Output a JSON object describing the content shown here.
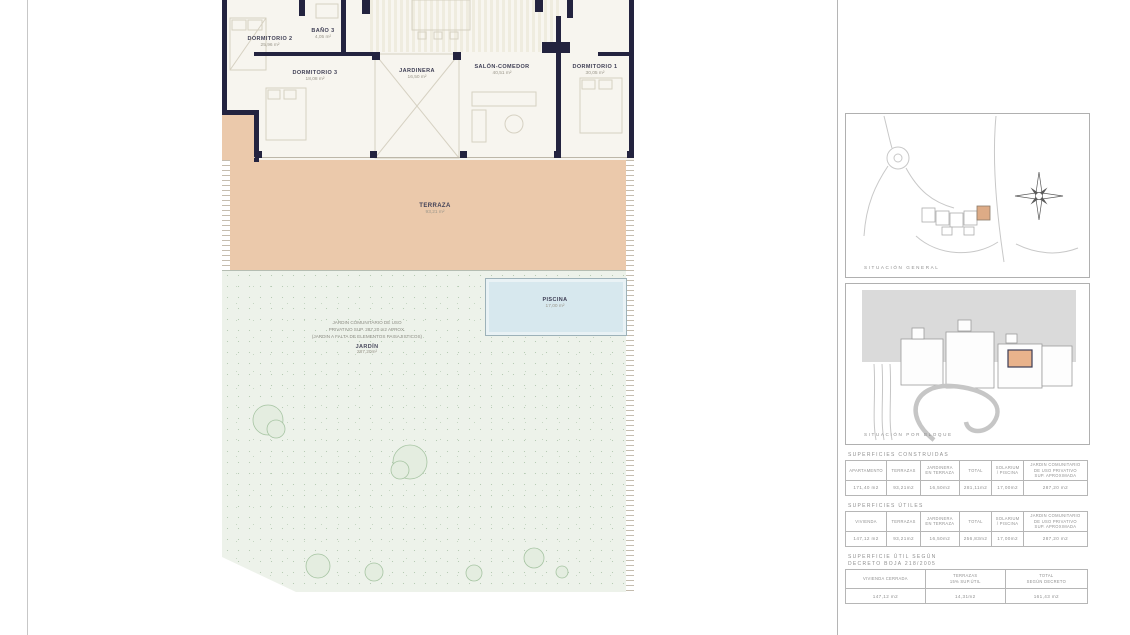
{
  "sheet": {
    "plan": {
      "rooms": [
        {
          "name": "DORMITORIO 2",
          "area": "25,96 m²"
        },
        {
          "name": "BAÑO 3",
          "area": "4,05 m²"
        },
        {
          "name": "DORMITORIO 3",
          "area": "18,08 m²"
        },
        {
          "name": "JARDINERA",
          "area": "16,50 m²"
        },
        {
          "name": "SALÓN-COMEDOR",
          "area": "40,51 m²"
        },
        {
          "name": "DORMITORIO 1",
          "area": "30,05 m²"
        }
      ],
      "terraza": {
        "name": "TERRAZA",
        "area": "93,21 m²"
      },
      "piscina": {
        "name": "PISCINA",
        "area": "17,00 m²"
      },
      "jardin": {
        "note": "JARDIN COMUNITARIO DE USO\nPRIVATIVO SUP. 287,20 m2 APROX.\n(JARDIN A FALTA DE ELEMENTOS PAISAJISTICOS)",
        "name": "JARDÍN",
        "area": "287,20m²"
      }
    },
    "sidebar": {
      "map_general_label": "SITUACIÓN GENERAL",
      "map_bloque_label": "SITUACIÓN POR BLOQUE",
      "tables": [
        {
          "title": "SUPERFICIES CONSTRUIDAS",
          "headers": [
            "APARTAMENTO",
            "TERRAZAS",
            "JARDINERA\nEN TERRAZA",
            "TOTAL",
            "SOLARIUM\n/ PISCINA",
            "JARDIN COMUNITARIO\nDE USO PRIVATIVO\nSUP. APROXIMADA"
          ],
          "values": [
            "171,40 m2",
            "93,21m2",
            "16,50m2",
            "281,11m2",
            "17,00m2",
            "287,20 m2"
          ]
        },
        {
          "title": "SUPERFICIES ÚTILES",
          "headers": [
            "VIVIENDA",
            "TERRAZAS",
            "JARDINERA\nEN TERRAZA",
            "TOTAL",
            "SOLARIUM\n/ PISCINA",
            "JARDIN COMUNITARIO\nDE USO PRIVATIVO\nSUP. APROXIMADA"
          ],
          "values": [
            "147,12 m2",
            "93,21m2",
            "16,50m2",
            "256,83m2",
            "17,00m2",
            "287,20 m2"
          ]
        },
        {
          "title": "SUPERFICIE ÚTIL SEGÚN\nDECRETO BOJA 218/2005",
          "headers": [
            "VIVIENDA CERRADA",
            "TERRAZAS\n15% SUP.ÚTIL",
            "TOTAL\nSEGÚN DECRETO"
          ],
          "values": [
            "147,12 m2",
            "14,31m2",
            "161,43 m2"
          ]
        }
      ]
    },
    "colors": {
      "wall": "#23233f",
      "terrace": "#ebc9ab",
      "garden": "#edf2ea",
      "pool": "#d7e8ee",
      "highlight": "#e2a87d"
    }
  }
}
